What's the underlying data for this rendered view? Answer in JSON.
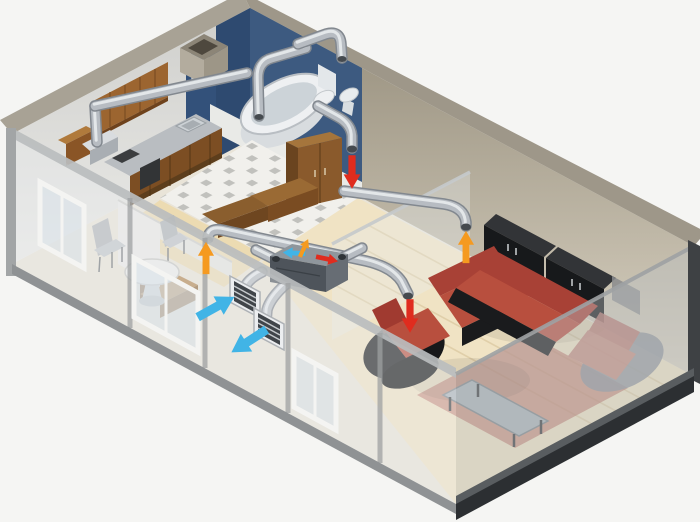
{
  "meta": {
    "title": "Apartment heat-recovery ventilation system - isometric cutaway",
    "image_type": "3D isometric cutaway illustration of a one-bedroom apartment with a single-room heat recovery ventilator and silver duct network",
    "visible_text": "none"
  },
  "colors": {
    "background": "#f5f5f3",
    "wall_top_left": "#a8a295",
    "wall_top_right": "#9e9789",
    "wall_inner_left_start": "#cfcfcc",
    "wall_inner_left_end": "#ebebe8",
    "wall_inner_right_start": "#958d7b",
    "wall_inner_right_end": "#d9d2c2",
    "floor_base": "#e9e4d8",
    "bathroom_wall": "#3d5a80",
    "bathroom_wall_dark": "#2e4a70",
    "bathroom_partition": "#33517a",
    "tile_floor": "#f1f0ec",
    "tile_accent": "#b5b5b1",
    "bedroom_floor": "#ecd9ae",
    "wood_floor": "#f0e3c4",
    "wood_plank_line": "#dcc9a2",
    "rug": "#b86a5e",
    "wood_cabinet": "#9c6530",
    "wood_cabinet_dark": "#7c4e23",
    "counter": "#b9bdc1",
    "wardrobe_front": "#8a5a2c",
    "wardrobe_side": "#6a441f",
    "wardrobe_top": "#a5753c",
    "sofa_red": "#b84f3e",
    "sofa_red_dark": "#a84136",
    "sofa_black": "#1a1b1d",
    "sideboard_black": "#17191b",
    "sideboard_top": "#323437",
    "duct_dark": "#82888f",
    "duct_mid": "#b7bcc2",
    "duct_highlight": "#e8ebed",
    "duct_mouth": "#454a4f",
    "unit_top": "#8f969c",
    "unit_front": "#4e545b",
    "unit_side": "#676d74",
    "arrow_supply_red": "#e02c1e",
    "arrow_extract_orange": "#f59a20",
    "arrow_outdoor_blue": "#41b4e6",
    "glass_wall": "#e8edf0",
    "window_frame": "#f4f4f2",
    "grille_frame": "#eceef0",
    "grille_slats": "#40454a",
    "base_trim_dark": "#2c2f32",
    "base_trim_grey": "#8f9294",
    "white_fixture": "#eef0f2"
  },
  "legend": {
    "red_down_arrows": "supply air delivered into rooms",
    "orange_up_arrows": "extract air drawn out of rooms into ducts",
    "blue_arrows": "outdoor air intake and exhaust through exterior wall grilles"
  },
  "rooms": [
    {
      "id": "kitchen",
      "position": "back-left",
      "contents": [
        "wood upper cabinets",
        "counter with sink and hob",
        "range hood with exhaust duct riser"
      ]
    },
    {
      "id": "bathroom",
      "position": "back-center",
      "contents": [
        "dark blue walls",
        "bathtub",
        "toilet",
        "washbasin",
        "small wall grille",
        "two arched extract duct drops"
      ]
    },
    {
      "id": "hallway",
      "position": "center",
      "contents": [
        "checkered tile floor",
        "tall wardrobe",
        "wood bench",
        "red supply diffuser arrow"
      ]
    },
    {
      "id": "bedroom",
      "position": "center-left",
      "contents": [
        "wood bed",
        "orange extract duct drop"
      ]
    },
    {
      "id": "dining-area",
      "position": "front-left",
      "contents": [
        "round pedestal table",
        "two chairs",
        "windows in glazed front wall"
      ]
    },
    {
      "id": "living-room",
      "position": "right",
      "contents": [
        "red corner sofa",
        "red armchair",
        "lounge chair",
        "glass coffee table",
        "red rug",
        "black sideboards",
        "wall screen",
        "red supply diffuser arrow",
        "orange extract duct drop"
      ]
    }
  ],
  "ventilation": {
    "unit": {
      "id": "heat-recovery-unit",
      "location": "on floor near front-left exterior wall",
      "markings": [
        "blue arrow toward outdoor grilles",
        "orange extract arrow on top",
        "red supply arrow toward rooms"
      ]
    },
    "exterior_grilles": [
      {
        "id": "intake-grille",
        "arrow": "blue arrow pointing into grille"
      },
      {
        "id": "exhaust-grille",
        "arrow": "blue arrow pointing away from grille"
      }
    ],
    "duct_runs": [
      "kitchen-hood-riser",
      "kitchen-wall-run",
      "bathroom-arch-1",
      "bathroom-arch-2",
      "hallway-supply-drop",
      "bedroom-extract-branch",
      "living-room-supply-branch",
      "living-room-extract-branch",
      "unit-outdoor-elbows"
    ],
    "diffuser_arrows": [
      {
        "id": "hallway-supply",
        "color_key": "arrow_supply_red",
        "direction": "down"
      },
      {
        "id": "living-room-supply",
        "color_key": "arrow_supply_red",
        "direction": "down"
      },
      {
        "id": "bedroom-extract",
        "color_key": "arrow_extract_orange",
        "direction": "up"
      },
      {
        "id": "living-room-extract",
        "color_key": "arrow_extract_orange",
        "direction": "up"
      },
      {
        "id": "outdoor-intake",
        "color_key": "arrow_outdoor_blue",
        "direction": "toward grille"
      },
      {
        "id": "outdoor-exhaust",
        "color_key": "arrow_outdoor_blue",
        "direction": "away from grille"
      }
    ]
  }
}
